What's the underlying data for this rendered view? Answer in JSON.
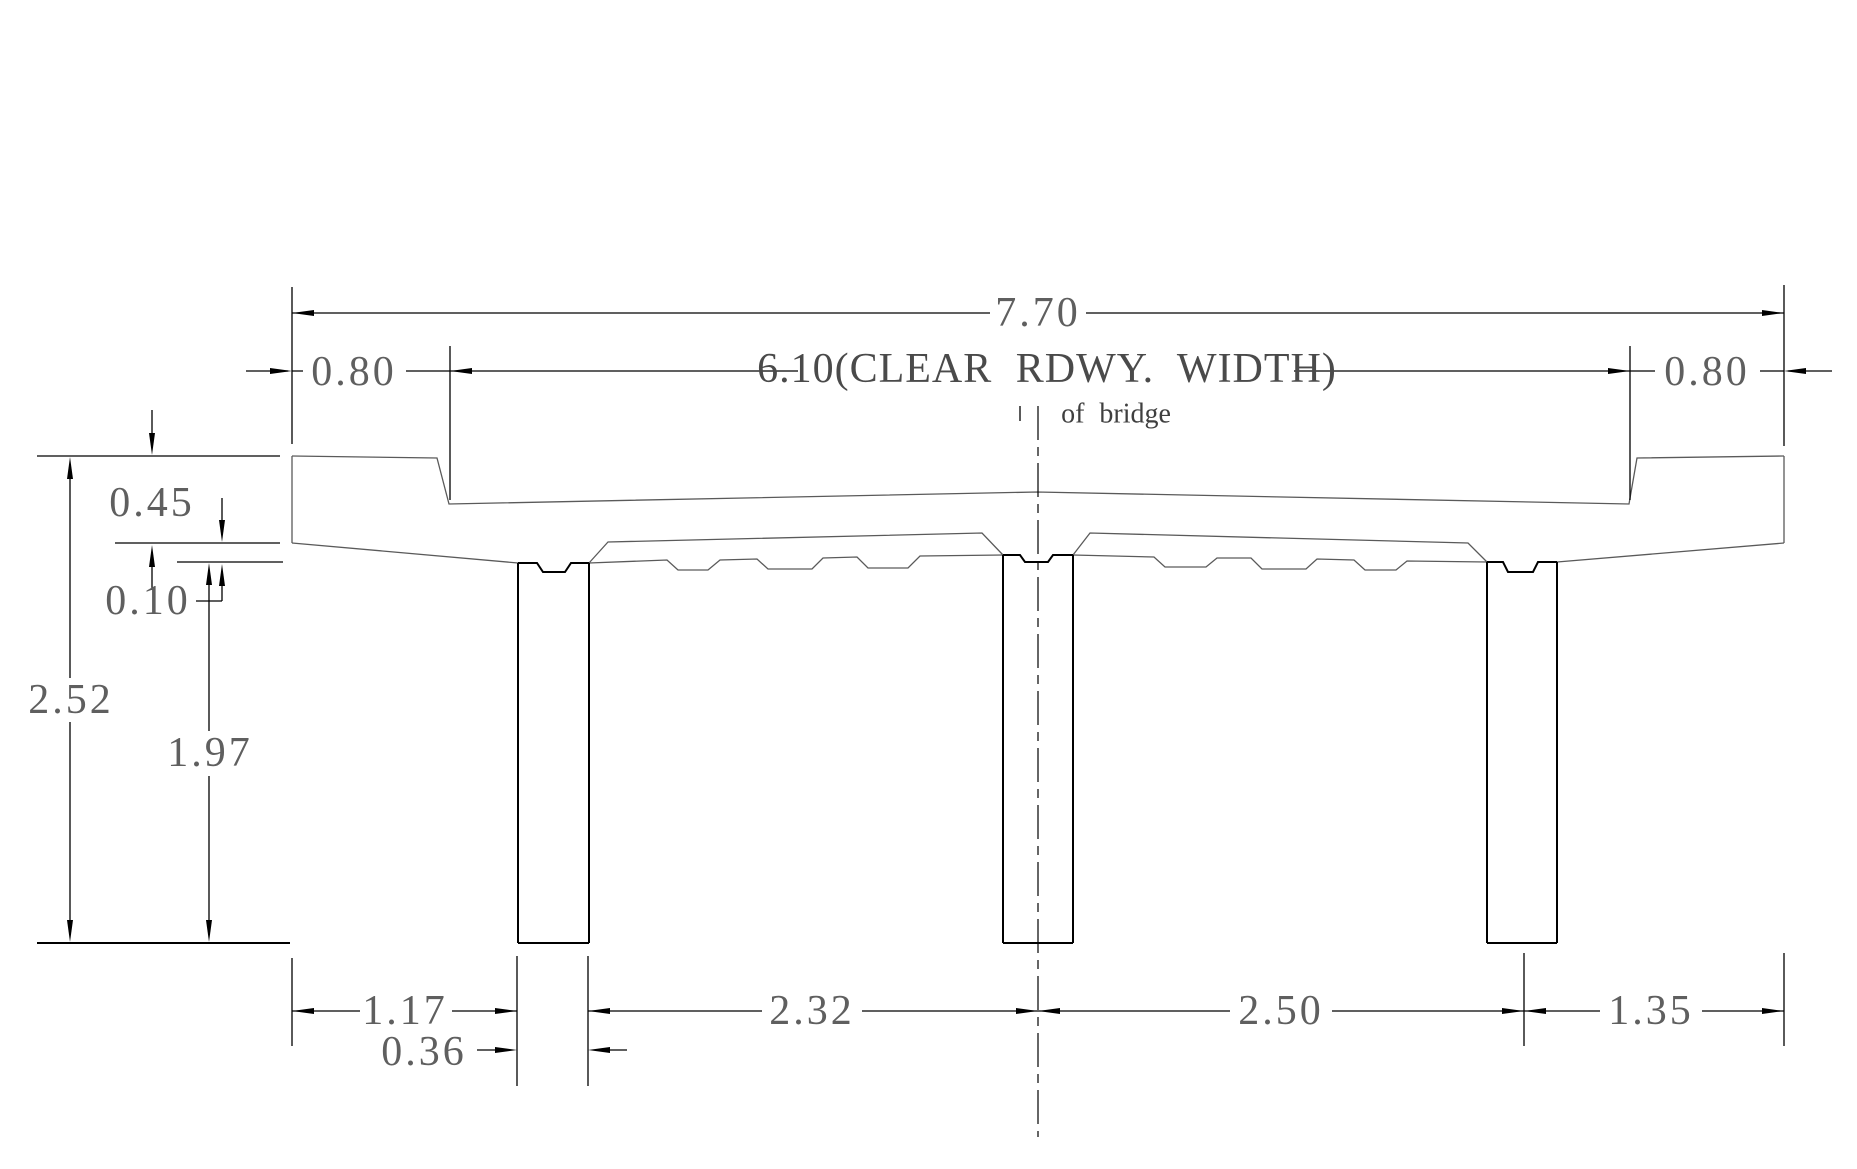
{
  "drawing": {
    "title": "bridge cross section",
    "overall_width": "7.70",
    "clear_roadway_width": "6.10(CLEAR RDWY. WIDTH)",
    "left_overhang": "0.80",
    "right_overhang": "0.80",
    "centerline_note": "of bridge",
    "slab_thickness": "0.45",
    "haunch_depth": "0.10",
    "overall_depth": "2.52",
    "column_height": "1.97",
    "edge_to_first_column": "1.17",
    "column_width": "0.36",
    "span_left": "2.32",
    "span_right": "2.50",
    "last_column_to_edge": "1.35"
  },
  "colors": {
    "background": "#ffffff",
    "dimension_lines": "#000000",
    "deck_outline": "#5a5a5a",
    "dimension_text": "#5f5f5f"
  }
}
